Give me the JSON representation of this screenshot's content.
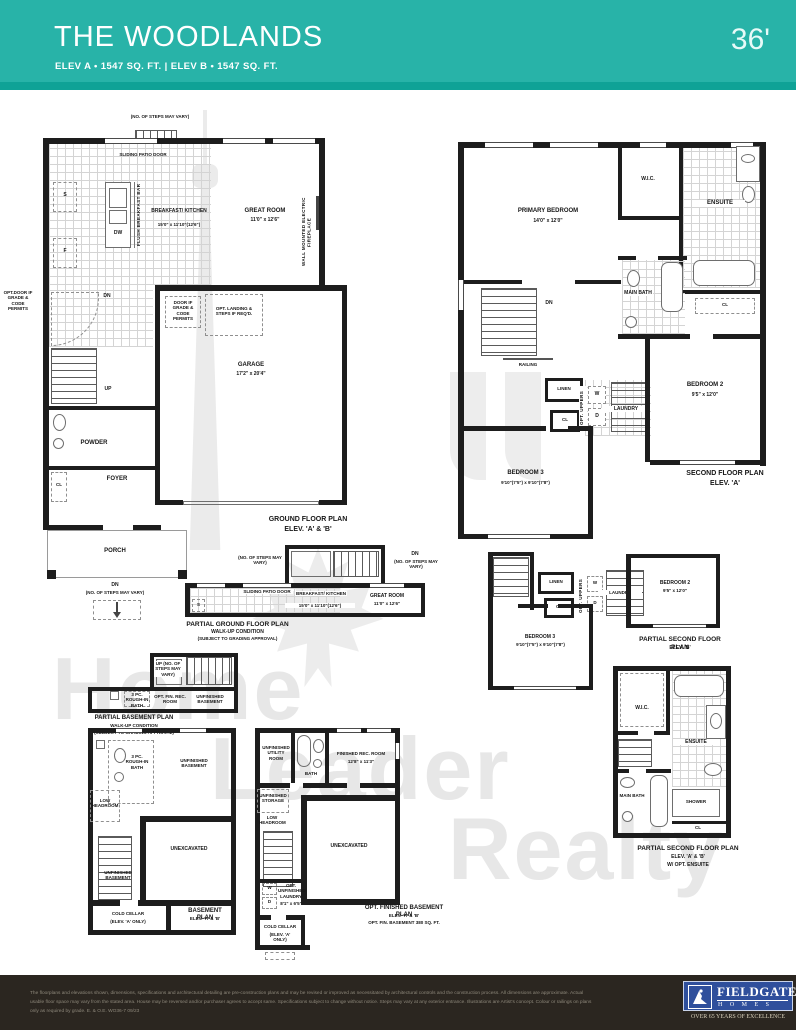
{
  "header": {
    "title": "THE WOODLANDS",
    "subtitle": "ELEV A  • 1547 SQ. FT.  |  ELEV B  • 1547 SQ. FT.",
    "lot_width": "36'",
    "accent_color": "#28b3a8"
  },
  "watermark": {
    "word1": "Home",
    "word2": "Leader",
    "word3": "Realty"
  },
  "ground": {
    "steps_note": "(NO. OF STEPS MAY VARY)",
    "sliding_door": "SLIDING PATIO DOOR",
    "s": "S",
    "f": "F",
    "dw": "DW",
    "flush_bar": "FLUSH BREAKFAST BAR",
    "kitchen_name": "BREAKFAST/ KITCHEN",
    "kitchen_dims": "15'0\" x 11'10\"(12'6\")",
    "great_name": "GREAT ROOM",
    "great_dims": "11'0\" x 12'6\"",
    "fireplace": "WALL MOUNTED ELECTRIC FIREPLACE",
    "opt_door": "OPT.DOOR IF GRADE & CODE PERMITS",
    "dn": "DN",
    "door_grade": "DOOR IF GRADE & CODE PERMITS",
    "opt_landing": "OPT. LANDING & STEPS IF REQ'D.",
    "up": "UP",
    "garage_name": "GARAGE",
    "garage_dims": "17'2\" x 20'4\"",
    "powder": "POWDER",
    "foyer": "FOYER",
    "cl": "CL",
    "porch": "PORCH",
    "dn2": "DN",
    "dn2_note": "(NO. OF STEPS MAY VARY)",
    "title1": "GROUND FLOOR PLAN",
    "title2": "ELEV. 'A' & 'B'"
  },
  "second": {
    "primary_name": "PRIMARY BEDROOM",
    "primary_dims": "14'0\" x 12'0\"",
    "wic": "W.I.C.",
    "ensuite": "ENSUITE",
    "cl_ensuite": "CL",
    "main_bath": "MAIN BATH",
    "dn": "DN",
    "railing": "RAILING",
    "linen": "LINEN",
    "cl2": "CL",
    "opt_uppers": "OPT. UPPERS",
    "w": "W",
    "d": "D",
    "laundry": "LAUNDRY",
    "bed2_name": "BEDROOM 2",
    "bed2_dims": "9'5\" x 12'0\"",
    "bed3_name": "BEDROOM 3",
    "bed3_dims": "9'10\"(7'5\") x 9'10\"(7'8\")",
    "title1": "SECOND FLOOR PLAN",
    "title2": "ELEV. 'A'"
  },
  "pground": {
    "steps_note": "(NO. OF STEPS MAY VARY)",
    "dn": "DN",
    "dn_note": "(NO. OF STEPS MAY VARY)",
    "sliding_door": "SLIDING PATIO DOOR",
    "kitchen_name": "BREAKFAST/ KITCHEN",
    "kitchen_dims": "15'0\" x 11'10\"(12'6\")",
    "great_name": "GREAT ROOM",
    "great_dims": "11'0\" x 12'6\"",
    "s": "S",
    "title1": "PARTIAL GROUND FLOOR PLAN",
    "title2": "WALK-UP CONDITION",
    "title3": "(SUBJECT TO GRADING APPROVAL)"
  },
  "psecondb": {
    "linen": "LINEN",
    "cl": "CL",
    "opt_uppers": "OPT. UPPERS",
    "w": "W",
    "d": "D",
    "laundry": "LAUNDRY",
    "bed2_name": "BEDROOM 2",
    "bed2_dims": "9'5\" x 12'0\"",
    "bed3_name": "BEDROOM 3",
    "bed3_dims": "9'10\"(7'5\") x 9'10\"(7'8\")",
    "title1": "PARTIAL SECOND FLOOR PLAN",
    "title2": "ELEV. 'B'"
  },
  "psecondens": {
    "wic": "W.I.C.",
    "ensuite": "ENSUITE",
    "shower": "SHOWER",
    "main_bath": "MAIN BATH",
    "cl": "CL",
    "title1": "PARTIAL SECOND FLOOR PLAN",
    "title2": "ELEV. 'A' & 'B'",
    "title3": "W/ OPT. ENSUITE"
  },
  "pbasement": {
    "up_note": "UP (NO. OF STEPS MAY VARY)",
    "bath": "3 PC. ROUGH-IN BATH",
    "rec": "OPT. FIN. REC. ROOM",
    "unfinished": "UNFINISHED BASEMENT",
    "title1": "PARTIAL BASEMENT PLAN",
    "title2": "WALK-UP CONDITION",
    "title3": "(SUBJECT TO GRADING APPROVAL)"
  },
  "basement": {
    "bath": "3 PC. ROUGH-IN BATH",
    "unfinished_a": "UNFINISHED BASEMENT",
    "low_headroom": "LOW HEADROOM",
    "unexcavated": "UNEXCAVATED",
    "unfinished_b": "UNFINISHED BASEMENT",
    "cold_cellar": "COLD CELLAR",
    "cold_note": "(ELEV. 'A' ONLY)",
    "title1": "BASEMENT PLAN",
    "title2": "ELEV. 'A' & 'B'"
  },
  "optbasement": {
    "utility": "UNFINISHED UTILITY ROOM",
    "bath": "BATH",
    "rec_name": "FINISHED REC. ROOM",
    "rec_dims": "12'8\" x 11'3\"",
    "storage": "UNFINISHED STORAGE",
    "low_headroom": "LOW HEADROOM",
    "unexcavated": "UNEXCAVATED",
    "laundry": "OPT. UNFINISHED LAUNDRY",
    "laundry_dims": "8'1\" x 6'5\"",
    "w": "W",
    "d": "D",
    "cold_cellar": "COLD CELLAR",
    "cold_note": "(ELEV. 'A' ONLY)",
    "title1": "OPT. FINISHED BASEMENT PLAN",
    "title2": "ELEV. 'A' & 'B'",
    "title3": "OPT. FIN. BASEMENT 380 SQ. FT."
  },
  "footer": {
    "line1": "The floorplans and elevations shown, dimensions, specifications and architectural detailing are pre-construction plans and may be revised or improved as necessitated by architectural controls and the construction process. All dimensions are approximate. Actual",
    "line2": "usable floor space may vary from the stated area. House may be reversed and/or purchaser agrees to accept same. Specifications subject to change without notice. Steps may vary at any exterior entrance. Illustrations are Artist's concept. Colour or railings on plans",
    "line3": "only as required by grade. E. & O.E.   WO36-7   09/23",
    "brand": "FIELDGATE",
    "homes": "H O M E S",
    "tagline": "OVER 65 YEARS OF EXCELLENCE"
  }
}
